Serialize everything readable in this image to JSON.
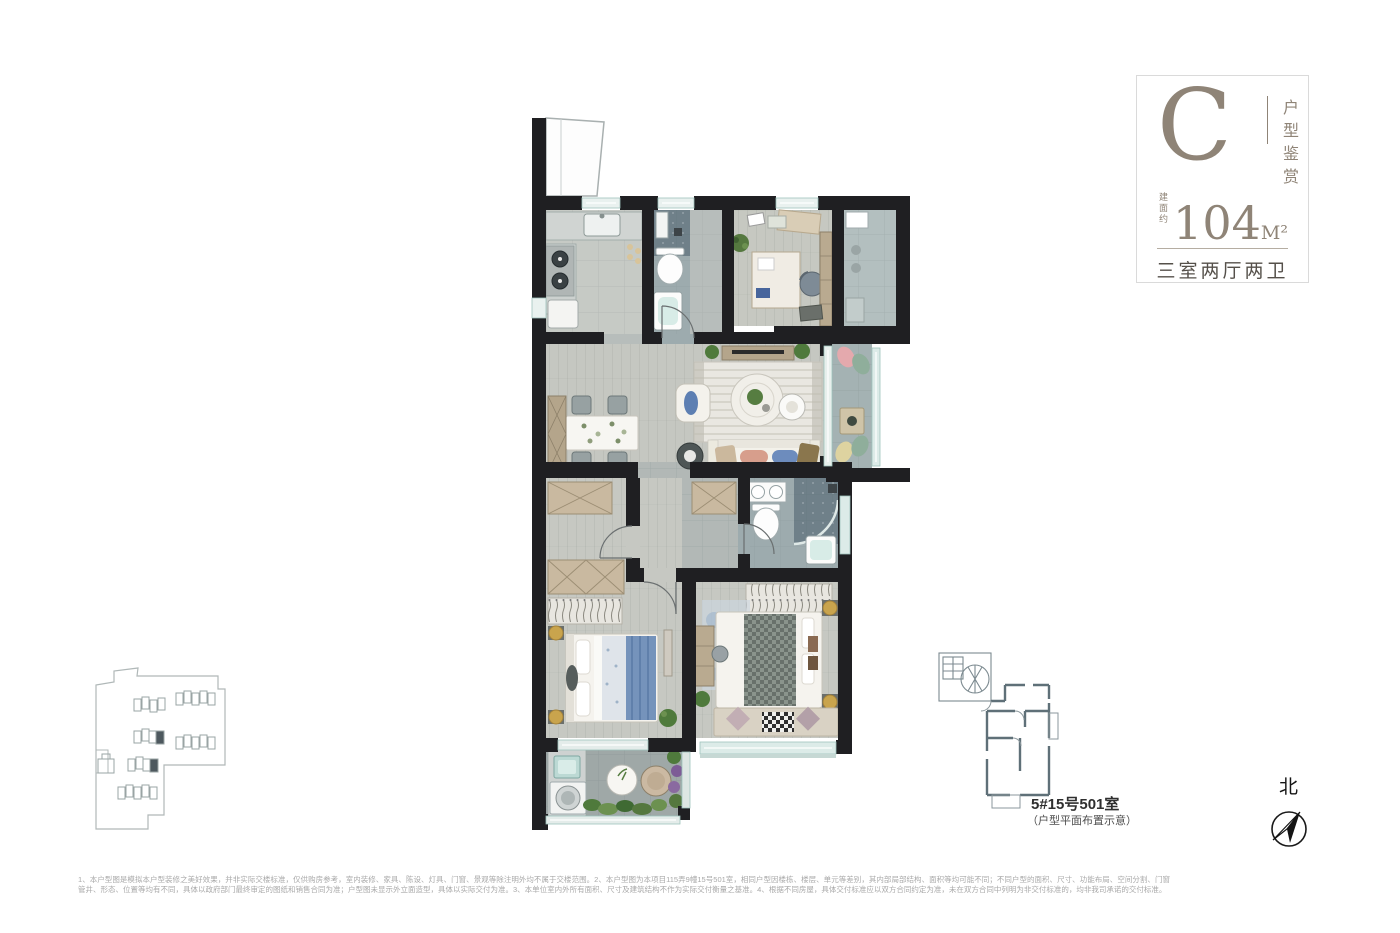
{
  "badge": {
    "type_letter": "C",
    "series_label": "户型鉴赏",
    "area_prefix": "建面约",
    "area_value": "104",
    "area_unit": "M²",
    "layout_label": "三室两厅两卫"
  },
  "key_plan": {
    "unit_label": "5#15号501室",
    "caption": "（户型平面布置示意）"
  },
  "compass": {
    "north_label": "北"
  },
  "disclaimer": {
    "line1": "1、本户型图是模拟本户型装修之美好效果，并非实际交楼标准，仅供购房参考，室内装修、家具、陈设、灯具、门窗、景观等除注明外均不属于交楼范围。2、本户型图为本项目115弄9幢15号501室，相同户型因楼栋、楼层、单元等差别，其内部局部结构、面积等均可能不同；不同户型的面积、尺寸、功能布局、空间分割、门窗管井、形态、位置等均有不同，具体以政府部门最终审定的图纸和销售合同为准；户型图未显示外立面造型，具体以实际交付为准。",
    "line2": "3、本单位室内外所有面积、尺寸及建筑结构不作为实际交付衡量之基准。4、根据不同房屋，具体交付标准应以双方合同约定为准，未在双方合同中列明为非交付标准的，均非我司承诺的交付标准。"
  },
  "colors": {
    "accent_taupe": "#8f8477",
    "wall_black": "#1f1f22",
    "keyplan_gray": "#5f7078"
  }
}
